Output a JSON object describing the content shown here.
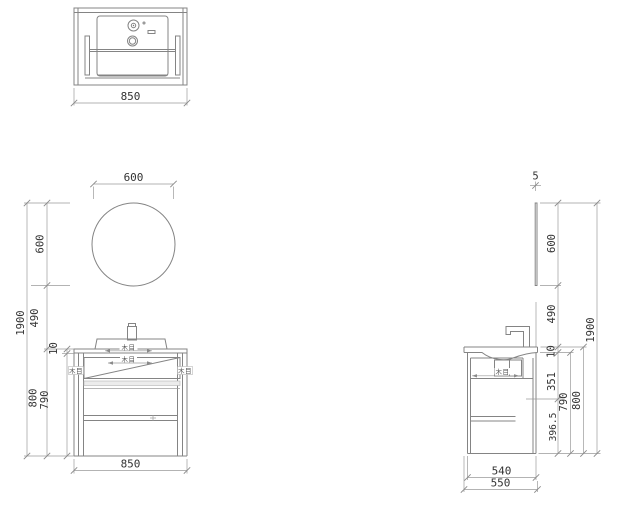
{
  "labels": {
    "wood_grain": "木目"
  },
  "top_view": {
    "width": "850"
  },
  "front_view": {
    "mirror_width": "600",
    "width": "850",
    "left_dims": {
      "total_height": "1900",
      "mirror_height": "600",
      "gap_height": "490",
      "cabinet_height": "800",
      "counter_thickness": "10",
      "body_height": "790"
    }
  },
  "side_view": {
    "mirror_thickness": "5",
    "cabinet_depth": "540",
    "total_depth": "550",
    "right_dims": {
      "total_height": "1900",
      "mirror_height": "600",
      "gap_height": "490",
      "counter_thickness": "10",
      "upper_section": "351",
      "lower_section": "396.5",
      "body_height": "790",
      "cabinet_height": "800"
    }
  }
}
